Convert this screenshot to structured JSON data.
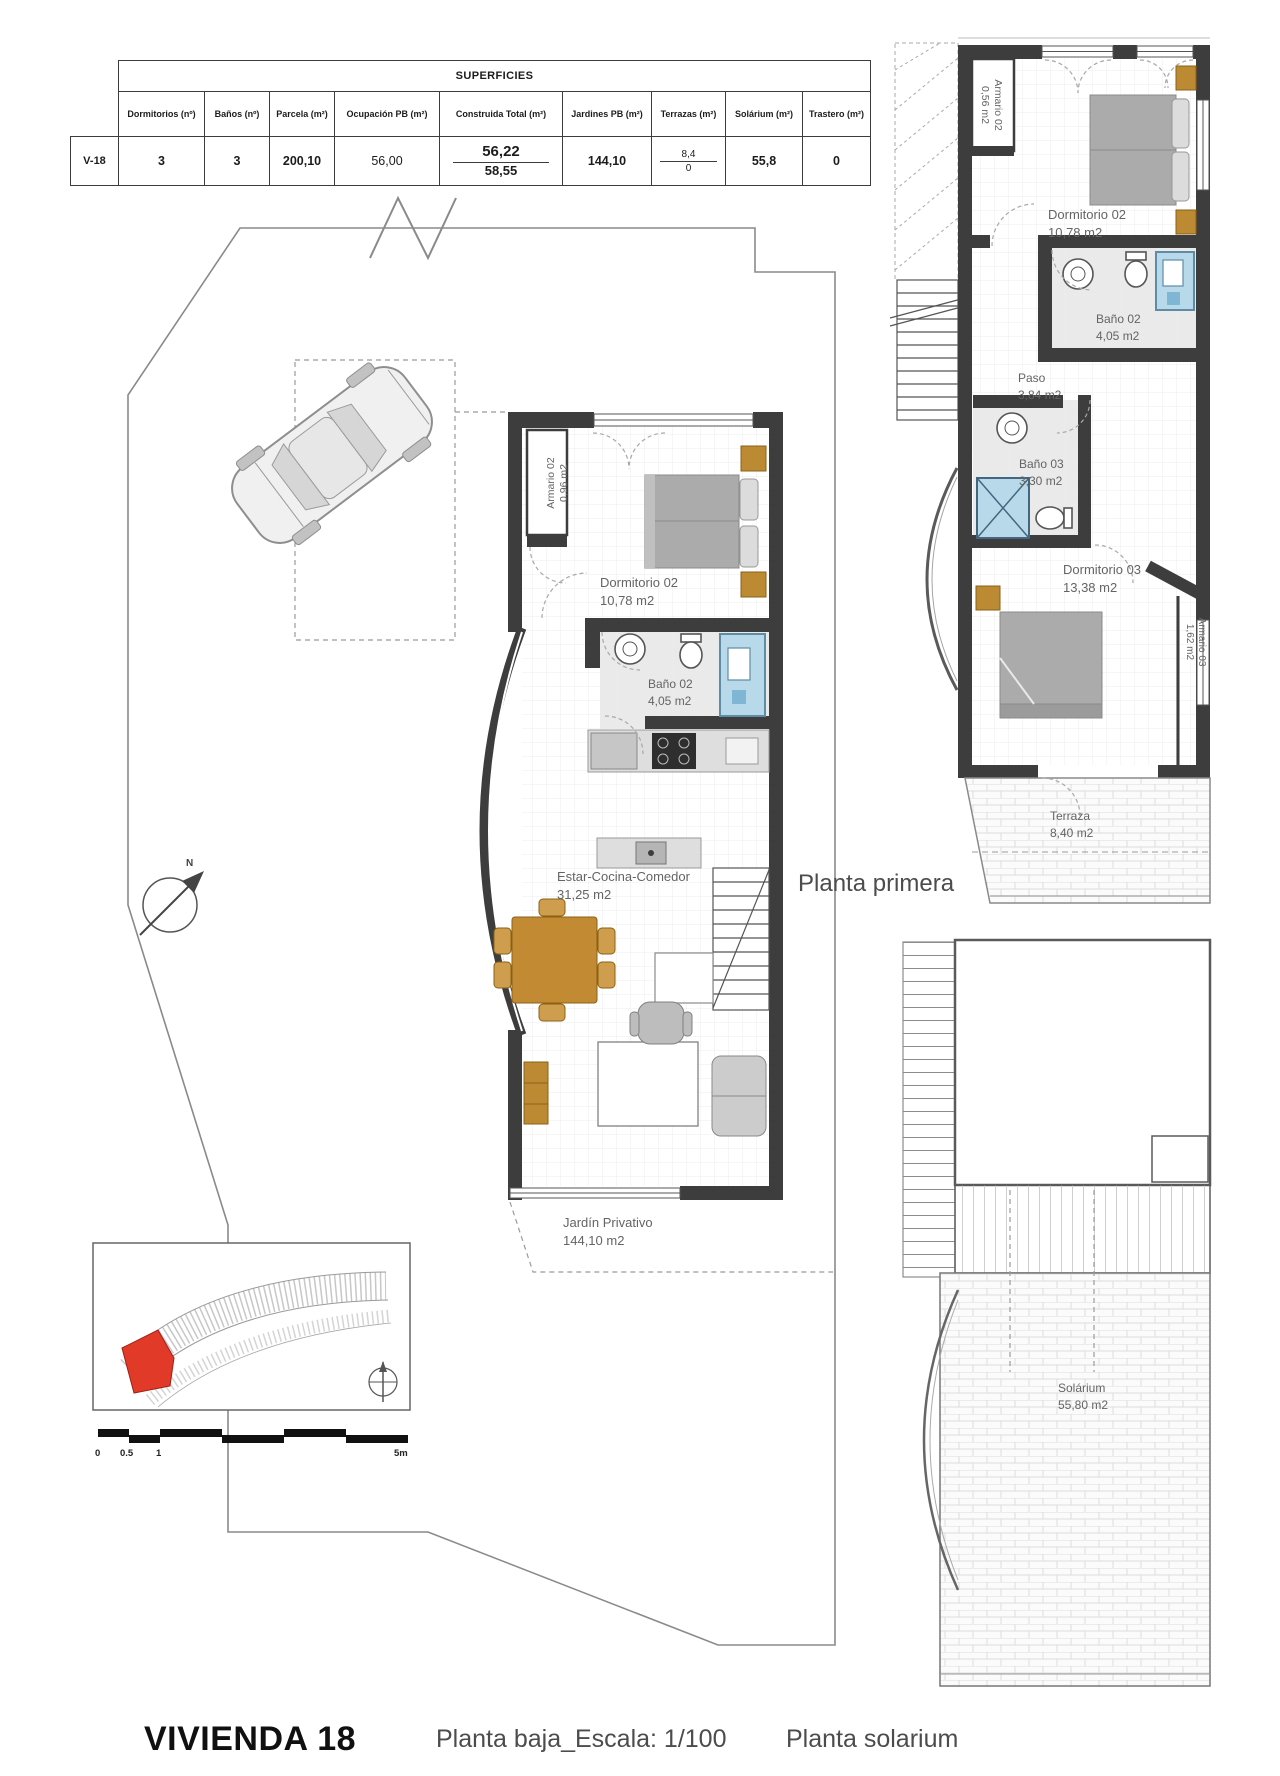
{
  "superficies_table": {
    "title": "SUPERFICIES",
    "headers": [
      "Dormitorios (nº)",
      "Baños (nº)",
      "Parcela (m²)",
      "Ocupación PB (m²)",
      "Construida Total (m²)",
      "Jardines PB (m²)",
      "Terrazas (m²)",
      "Solárium (m²)",
      "Trastero (m²)"
    ],
    "row_label": "V-18",
    "dormitorios": "3",
    "banos": "3",
    "parcela": "200,10",
    "ocupacion_pb": "56,00",
    "construida_a": "56,22",
    "construida_b": "58,55",
    "jardines_pb": "144,10",
    "terrazas_a": "8,4",
    "terrazas_b": "0",
    "solarium": "55,8",
    "trastero": "0"
  },
  "planta_baja": {
    "armario02": {
      "name": "Armario 02",
      "area": "0,96 m2"
    },
    "dormitorio02": {
      "name": "Dormitorio 02",
      "area": "10,78 m2"
    },
    "bano02": {
      "name": "Baño 02",
      "area": "4,05 m2"
    },
    "estar": {
      "name": "Estar-Cocina-Comedor",
      "area": "31,25 m2"
    },
    "jardin": {
      "name": "Jardín Privativo",
      "area": "144,10 m2"
    }
  },
  "planta_primera": {
    "caption": "Planta primera",
    "armario02": {
      "name": "Armario 02",
      "area": "0,56 m2"
    },
    "dormitorio02": {
      "name": "Dormitorio 02",
      "area": "10,78 m2"
    },
    "bano02": {
      "name": "Baño 02",
      "area": "4,05 m2"
    },
    "paso": {
      "name": "Paso",
      "area": "3,84 m2"
    },
    "bano03": {
      "name": "Baño 03",
      "area": "3,30 m2"
    },
    "dormitorio03": {
      "name": "Dormitorio 03",
      "area": "13,38 m2"
    },
    "armario03": {
      "name": "Armario 03",
      "area": "1,62 m2"
    },
    "terraza": {
      "name": "Terraza",
      "area": "8,40 m2"
    }
  },
  "planta_solarium": {
    "caption": "Planta solarium",
    "solarium": {
      "name": "Solárium",
      "area": "55,80 m2"
    }
  },
  "footer": {
    "title": "VIVIENDA 18",
    "scale": "Planta baja_Escala: 1/100"
  },
  "scale_bar": {
    "t0": "0",
    "t05": "0.5",
    "t1": "1",
    "t5": "5m"
  },
  "compass": {
    "north": "N"
  }
}
